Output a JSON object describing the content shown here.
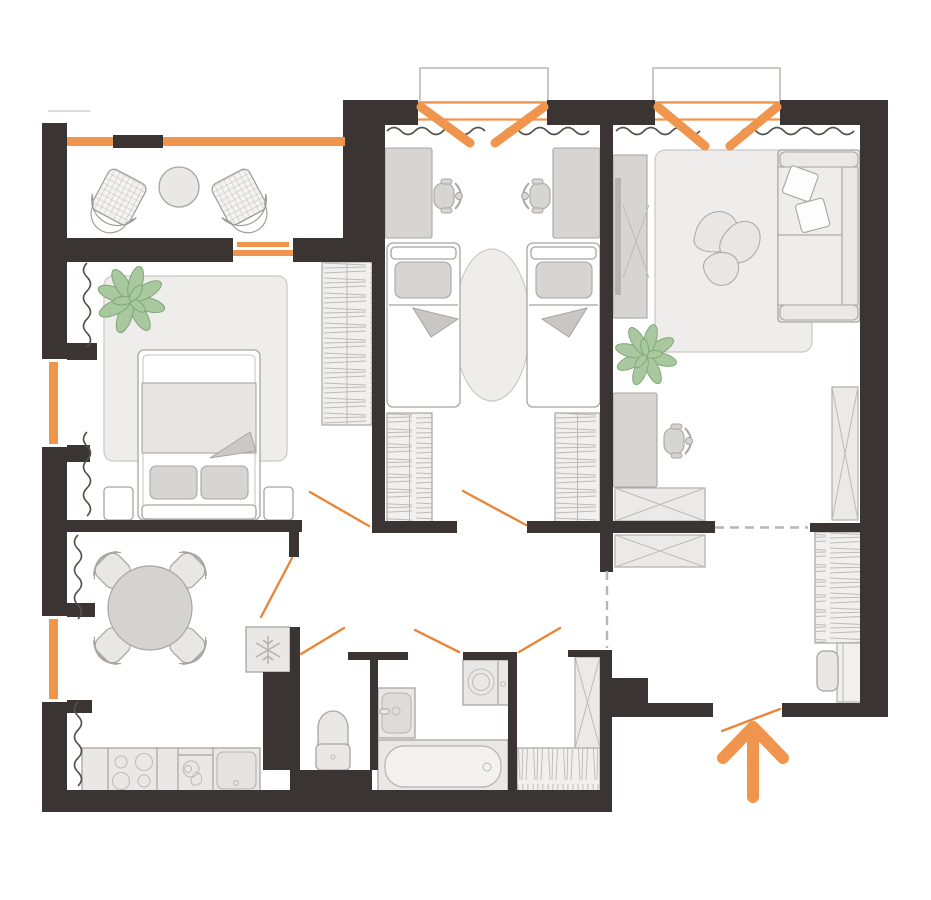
{
  "meta": {
    "type": "apartment-floor-plan",
    "canvas": {
      "width": 931,
      "height": 900
    }
  },
  "colors": {
    "wall": "#3a3532",
    "accent": "#f0954e",
    "accent2": "#e8873b",
    "stroke": "#a8a5a2",
    "furnLight": "#eae8e6",
    "furnMid": "#d7d5d2",
    "hatch": "#bdbab7",
    "rug": "#efedeb",
    "rugStroke": "#cbc8c5",
    "dash": "#b8b5b2",
    "curtain": "#55504c",
    "plant": "#a9c8a0",
    "plantStroke": "#7fa877",
    "slab": "#b8b5b2",
    "wrdFill": "#f1f0ee"
  },
  "rooms": [
    {
      "name": "balcony",
      "items": [
        "wicker-chair",
        "wicker-chair",
        "coffee-table",
        "glazing"
      ]
    },
    {
      "name": "bedroom",
      "items": [
        "double-bed",
        "pillow",
        "pillow",
        "blanket",
        "nightstand",
        "nightstand",
        "area-rug",
        "wardrobe",
        "plant",
        "window",
        "curtains",
        "door-swing"
      ]
    },
    {
      "name": "kids-room",
      "items": [
        "single-bed",
        "single-bed",
        "desk",
        "desk",
        "desk-chair",
        "desk-chair",
        "wardrobe",
        "wardrobe",
        "oval-rug",
        "balcony-door",
        "curtains",
        "door-swing"
      ]
    },
    {
      "name": "living-room",
      "items": [
        "sofa",
        "throw-pillow",
        "throw-pillow",
        "area-rug",
        "tv-console",
        "tv",
        "desk",
        "desk-chair",
        "plant",
        "wardrobe",
        "cabinet",
        "cabinet",
        "balcony-door",
        "curtains"
      ]
    },
    {
      "name": "kitchen-dining",
      "items": [
        "round-table",
        "chair",
        "chair",
        "chair",
        "chair",
        "counter",
        "stove",
        "faucet-sink",
        "basin-sink",
        "fridge",
        "window",
        "curtains",
        "door-swing"
      ]
    },
    {
      "name": "wc",
      "items": [
        "toilet",
        "door-swing"
      ]
    },
    {
      "name": "bathroom",
      "items": [
        "washbasin",
        "bathtub",
        "washing-machine",
        "door-swing",
        "door-swing"
      ]
    },
    {
      "name": "hallway",
      "items": [
        "closet",
        "tall-wardrobe",
        "coat-wardrobe",
        "bench",
        "entrance-door-swing",
        "entrance-arrow",
        "open-zone-dashed-lines"
      ]
    }
  ]
}
